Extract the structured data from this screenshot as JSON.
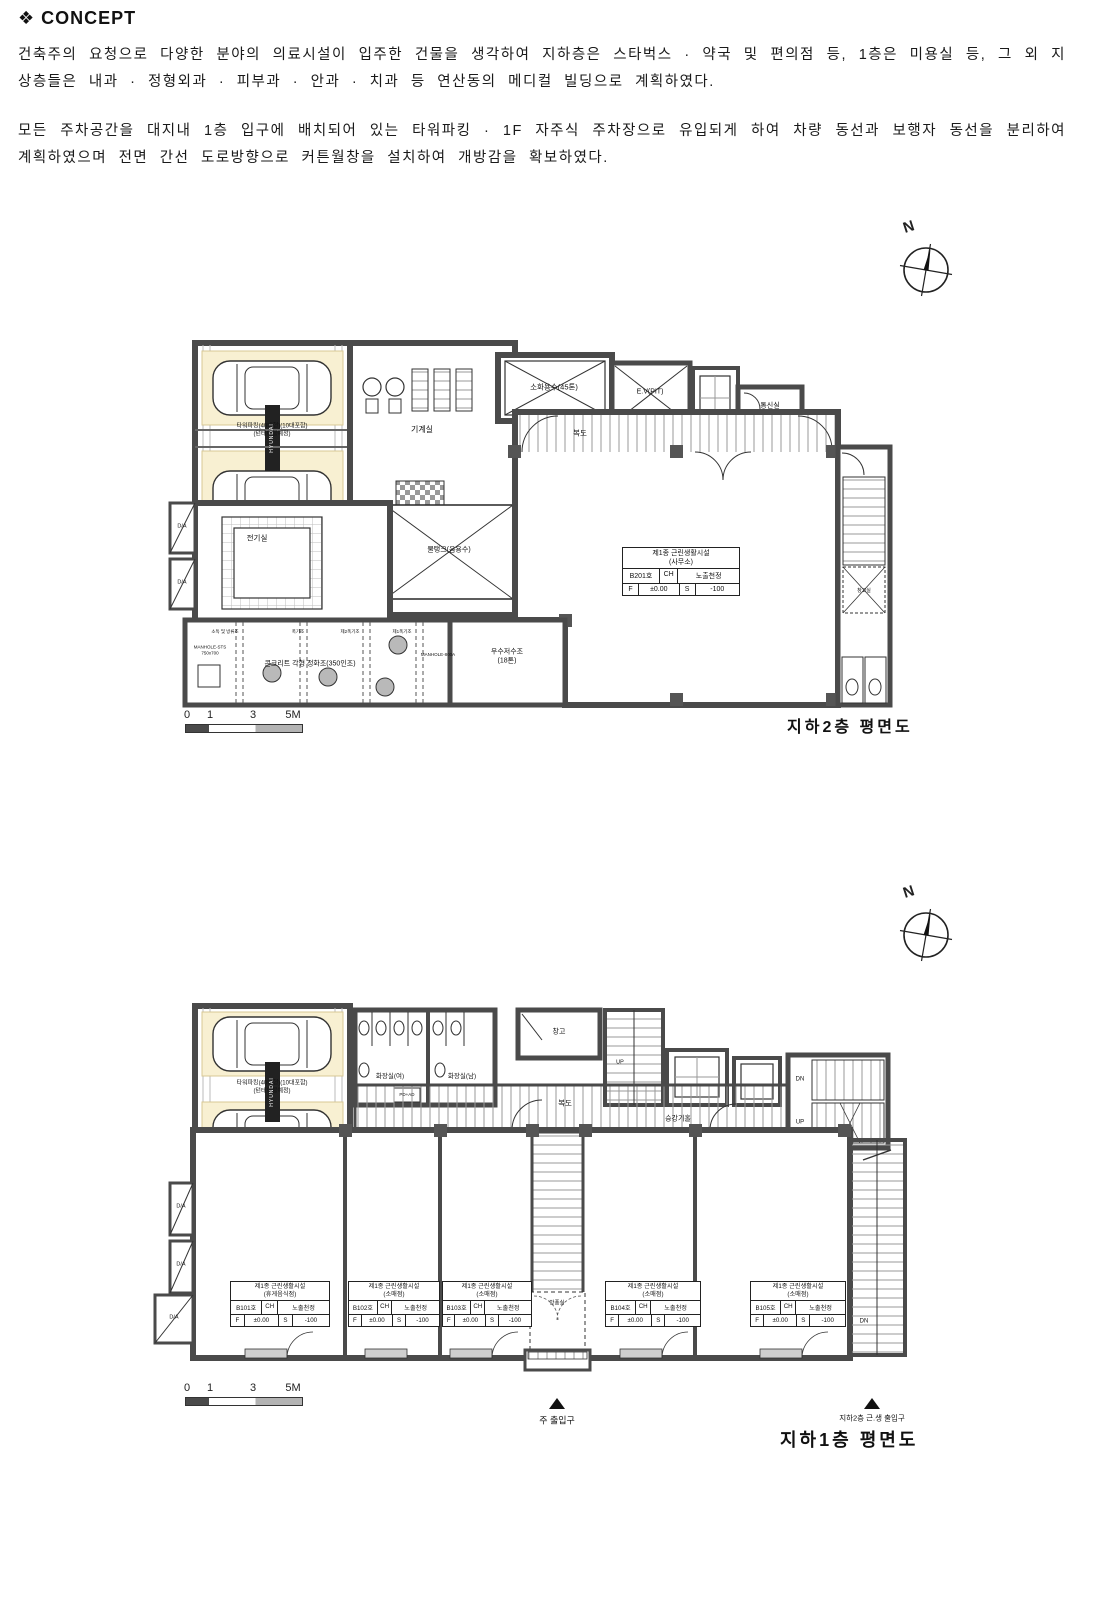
{
  "concept": {
    "marker": "❖",
    "heading": "CONCEPT",
    "para1": "건축주의 요청으로 다양한 분야의 의료시설이 입주한 건물을 생각하여 지하층은 스타벅스 · 약국 및 편의점 등, 1층은 미용실 등, 그 외 지상층들은 내과 · 정형외과 · 피부과 · 안과 · 치과 등 연산동의 메디컬 빌딩으로 계획하였다.",
    "para2": "모든 주차공간을 대지내 1층 입구에 배치되어 있는 타워파킹 · 1F 자주식 주차장으로 유입되게 하여 차량 동선과 보행자 동선을 분리하여 계획하였으며 전면 간선 도로방향으로 커튼월창을 설치하여 개방감을 확보하였다."
  },
  "compass": {
    "n": "N"
  },
  "scalebar": {
    "n0": "0",
    "n1": "1",
    "n3": "3",
    "n5": "5M"
  },
  "plan_b2": {
    "title": "지하2층 평면도",
    "labels": {
      "tower1": "타워파킹(40대형)(10대포함)",
      "tower2": "(턴테이블예정)",
      "brand": "HYUNDAI",
      "machine": "기계실",
      "fire_water": "소화용수(45톤)",
      "ev_pit": "E.V(PIT)",
      "comm": "통신실",
      "corridor": "복도",
      "electric": "전기실",
      "tank": "물탱크(음용수)",
      "manhole1a": "MANHOLE-STS",
      "manhole1b": "750x700",
      "septic": "콘크리트 각형 정화조(350인조)",
      "manhole2": "MANHOLE-800A",
      "rain1": "우수저수조",
      "rain2": "(18톤)",
      "t1": "소독 및 방류조",
      "t2": "폭기조",
      "t3": "제2폭기조",
      "t4": "제1폭기조",
      "storage": "창고실",
      "da": "D/A"
    },
    "unit": {
      "use": "제1종 근린생활시설",
      "use_detail": "(사무소)",
      "room": "B201호",
      "ch": "CH",
      "ceiling": "노출천정",
      "f": "F",
      "f_val": "±0.00",
      "s": "S",
      "s_val": "-100"
    }
  },
  "plan_b1": {
    "title": "지하1층 평면도",
    "labels": {
      "tower1": "타워파킹(40대형)(10대포함)",
      "tower2": "(턴테이블예정)",
      "brand": "HYUNDAI",
      "toilet_w": "화장실(여)",
      "toilet_m": "화장실(남)",
      "pdad": "PD+AD",
      "storage": "창고",
      "up": "UP",
      "corridor": "복도",
      "hall": "승강기홀",
      "dn": "DN",
      "up2": "UP",
      "dn2": "DN",
      "wind": "방풍실",
      "da": "D/A",
      "main_ent": "주 출입구",
      "b2_ent": "지하2층 근.생 출입구"
    },
    "units": [
      {
        "use": "제1종 근린생활시설",
        "use_detail": "(휴게음식점)",
        "room": "B101호",
        "ch": "CH",
        "ceiling": "노출천정",
        "f": "F",
        "f_val": "±0.00",
        "s": "S",
        "s_val": "-100"
      },
      {
        "use": "제1종 근린생활시설",
        "use_detail": "(소매점)",
        "room": "B102호",
        "ch": "CH",
        "ceiling": "노출천정",
        "f": "F",
        "f_val": "±0.00",
        "s": "S",
        "s_val": "-100"
      },
      {
        "use": "제1종 근린생활시설",
        "use_detail": "(소매점)",
        "room": "B103호",
        "ch": "CH",
        "ceiling": "노출천정",
        "f": "F",
        "f_val": "±0.00",
        "s": "S",
        "s_val": "-100"
      },
      {
        "use": "제1종 근린생활시설",
        "use_detail": "(소매점)",
        "room": "B104호",
        "ch": "CH",
        "ceiling": "노출천정",
        "f": "F",
        "f_val": "±0.00",
        "s": "S",
        "s_val": "-100"
      },
      {
        "use": "제1종 근린생활시설",
        "use_detail": "(소매점)",
        "room": "B105호",
        "ch": "CH",
        "ceiling": "노출천정",
        "f": "F",
        "f_val": "±0.00",
        "s": "S",
        "s_val": "-100"
      }
    ]
  }
}
